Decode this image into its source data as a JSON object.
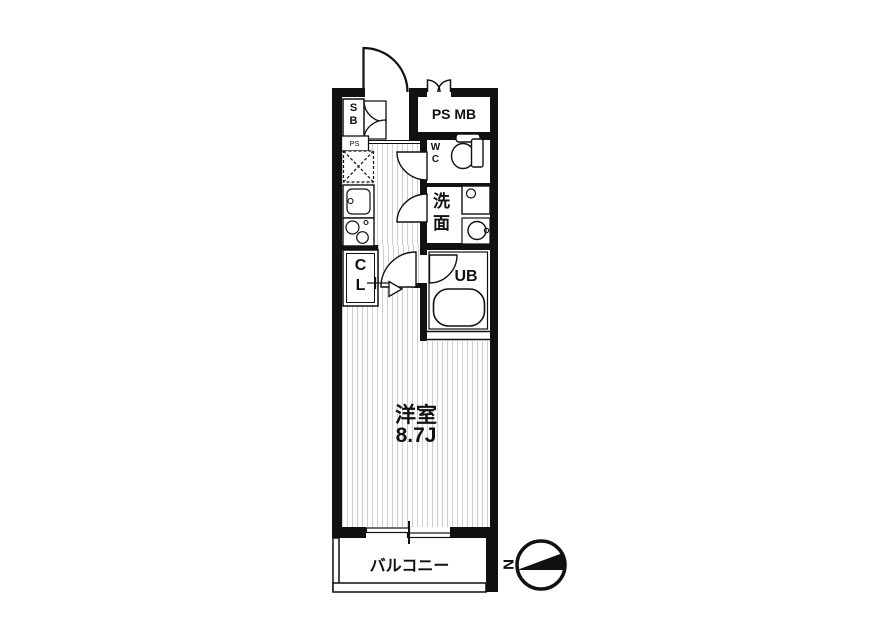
{
  "floorplan": {
    "labels": {
      "shoe_box": "S\nB",
      "pipe_space": "PS",
      "pipe_space_meter_box": "PS MB",
      "toilet": "W\nC",
      "washroom": "洗\n面",
      "closet": "C\nL",
      "unit_bath": "UB",
      "room_name": "洋室",
      "room_size": "8.7J",
      "balcony": "バルコニー",
      "compass_north": "N"
    },
    "colors": {
      "wall": "#111111",
      "line": "#111111",
      "floor_stripe": "#cfcfcf",
      "background": "#ffffff"
    }
  }
}
